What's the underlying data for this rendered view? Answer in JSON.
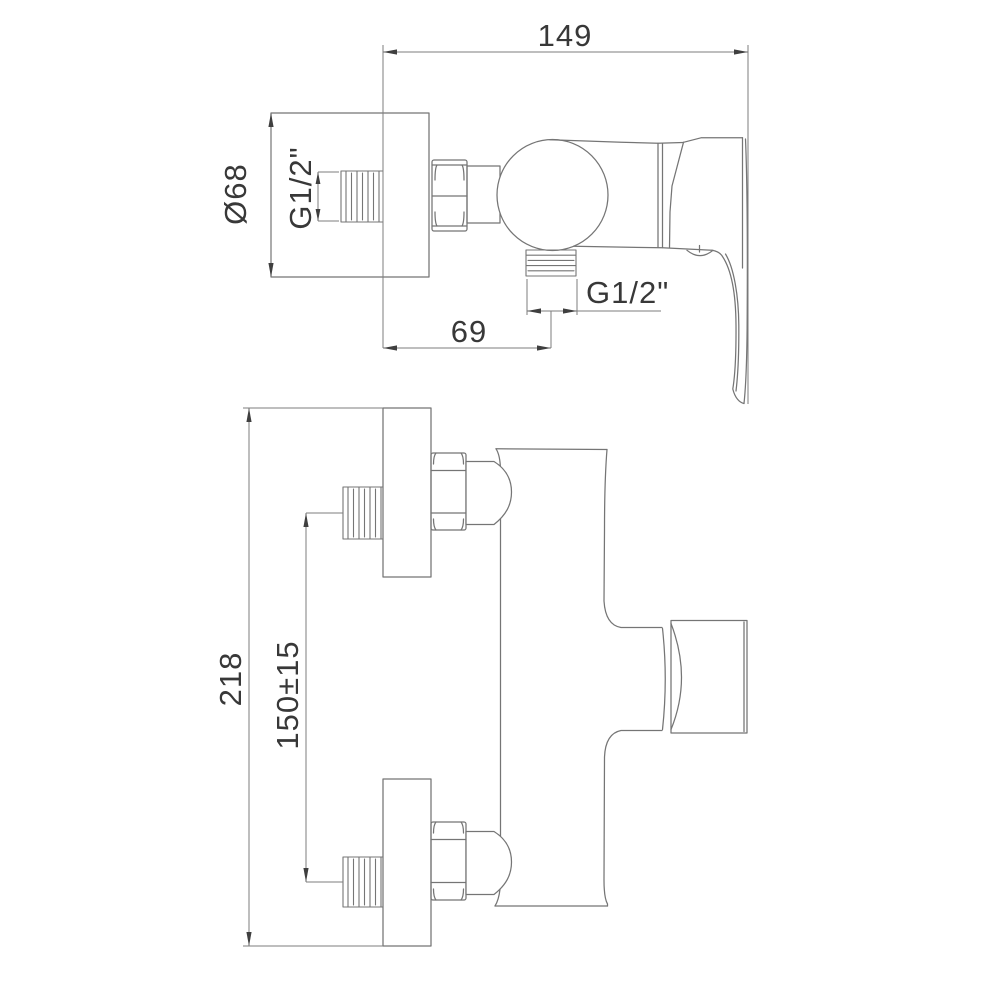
{
  "dimensions": {
    "overall_depth": "149",
    "escutcheon_diameter": "Ø68",
    "inlet_thread": "G1/2\"",
    "outlet_thread": "G1/2\"",
    "wall_to_outlet_center": "69",
    "overall_width": "218",
    "connection_spacing": "150±15"
  },
  "colors": {
    "line": "#757575",
    "dimension_line": "#7d7d7d",
    "text": "#383838",
    "background": "#ffffff"
  }
}
